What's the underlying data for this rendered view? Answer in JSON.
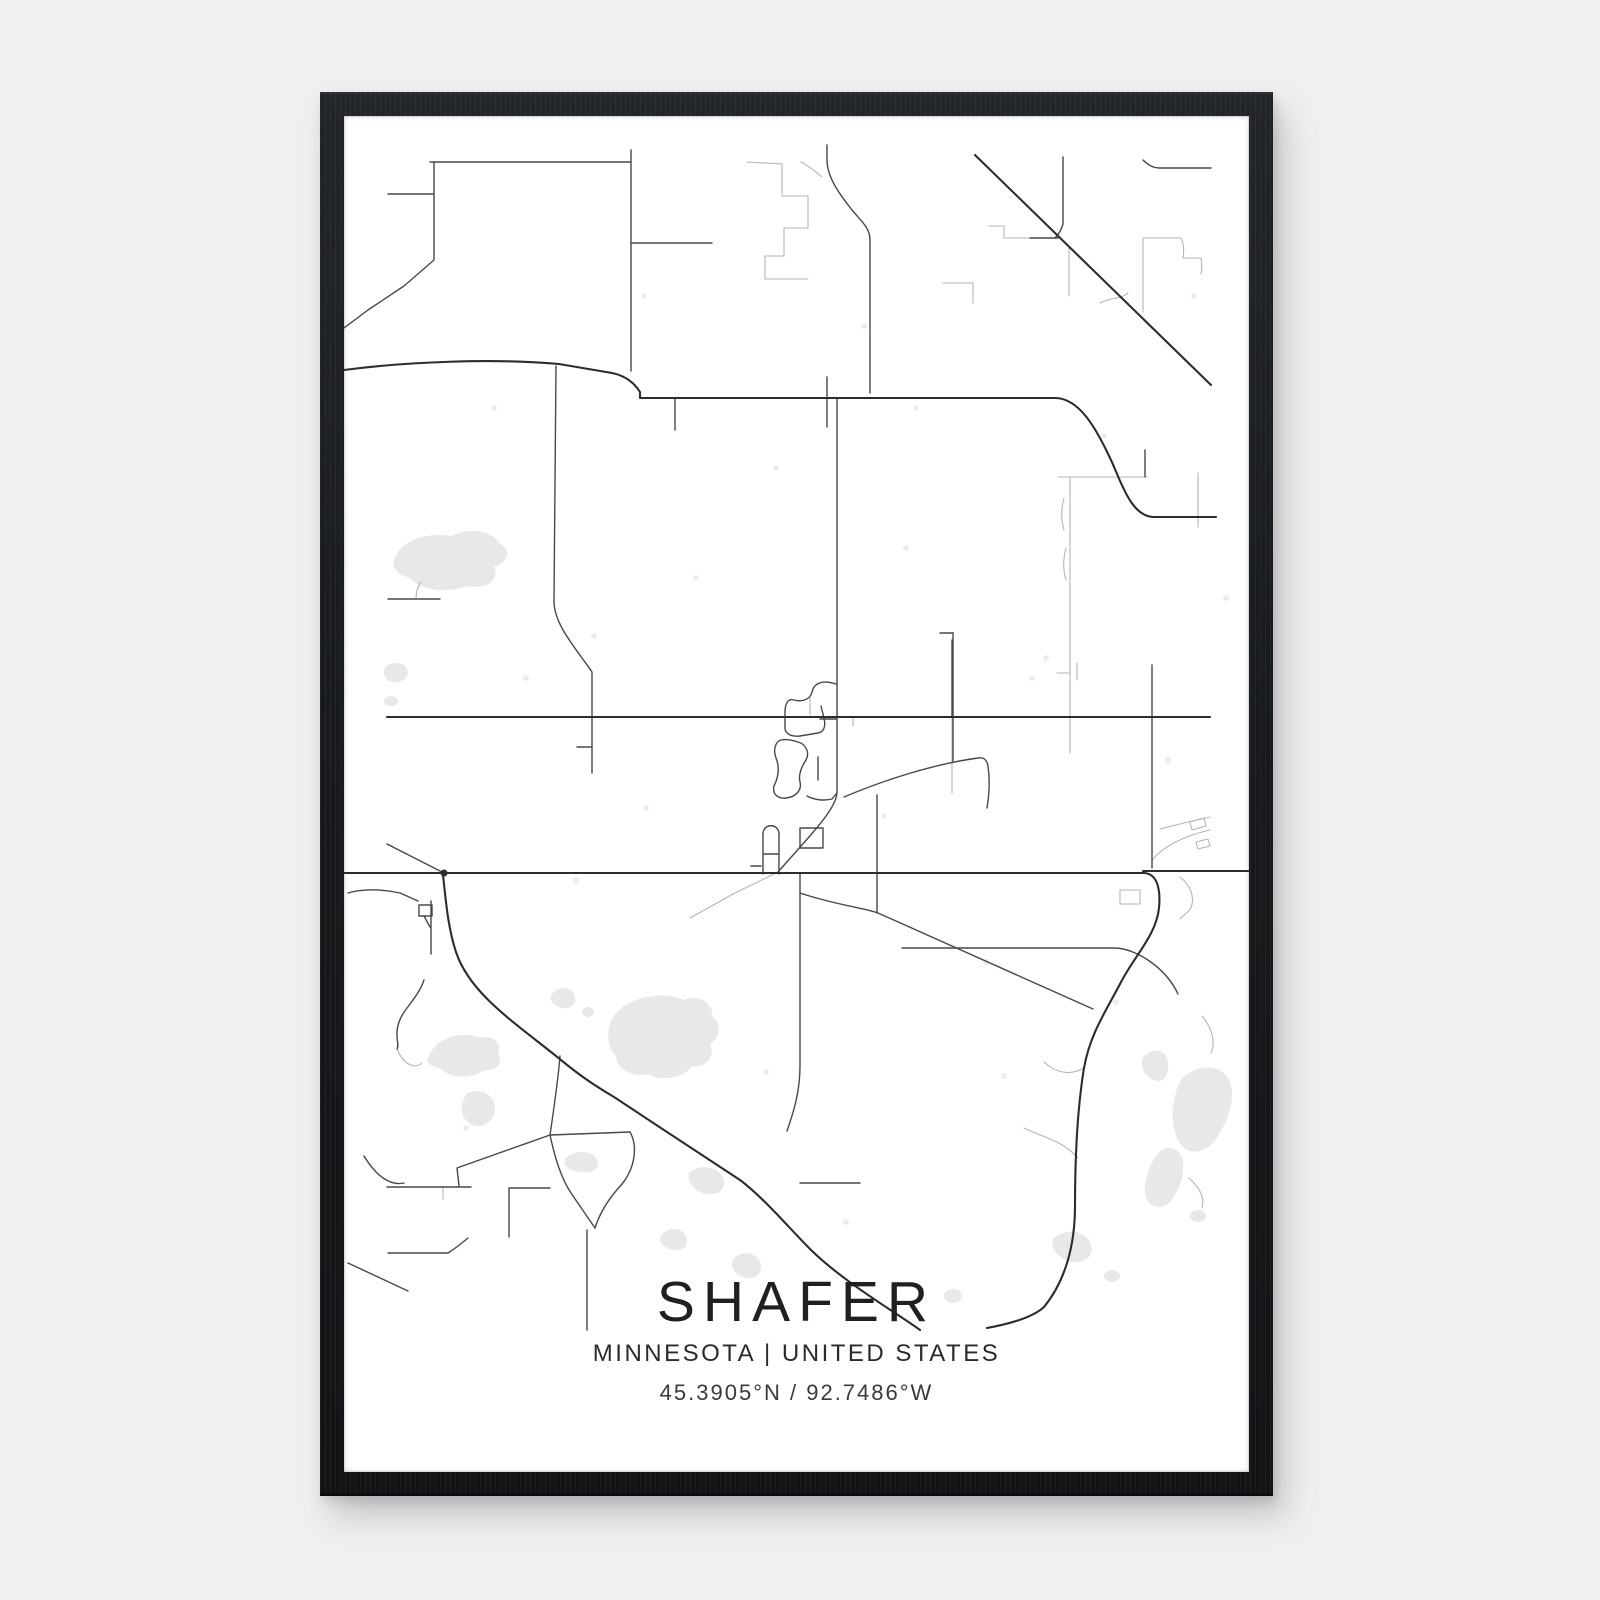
{
  "page": {
    "background": "#f0f0f1"
  },
  "poster": {
    "frame_color": "#191b1e",
    "paper_color": "#ffffff",
    "title": "SHAFER",
    "subtitle": "MINNESOTA | UNITED STATES",
    "coordinates": "45.3905°N / 92.7486°W",
    "map": {
      "location": "Shafer, Minnesota, United States",
      "viewBox": "0 0 905 1356",
      "road_color_main": "#2c2c2f",
      "road_color_medium": "#48484c",
      "road_color_light": "#b4b4b9",
      "water_color": "#e8e8ea",
      "speckle_color": "#ededef",
      "layers": [
        {
          "id": "water",
          "type": "fill",
          "color": "#e8e8ea",
          "paths": [
            "M52,440 C58,424 84,416 108,420 C128,410 150,416 156,428 C168,434 164,446 150,451 C156,463 144,474 124,470 C102,478 76,474 66,462 C52,458 46,450 52,440 Z",
            "M42,551 C48,545 60,546 63,553 C66,561 58,568 48,566 C40,564 38,556 42,551 Z",
            "M40,585 a7,5 0 1 0 14,0 a7,5 0 1 0 -14,0 Z",
            "M85,940 C92,922 118,914 136,922 C150,918 158,928 154,938 C160,946 152,956 140,954 C128,964 104,962 96,952 C86,950 80,946 85,940 Z",
            "M122,978 C132,972 146,976 150,986 C154,998 146,1010 134,1010 C122,1010 116,998 118,988 Z",
            "M270,900 C282,882 316,874 340,884 C356,878 370,888 368,900 C378,908 376,922 366,928 C372,940 362,952 348,950 C340,962 318,966 304,958 C288,962 272,952 272,940 C262,932 262,910 270,900 Z",
            "M208,878 C214,870 226,870 230,878 C234,886 228,894 218,892 C210,890 204,884 208,878 Z",
            "M238,896 a6,5 0 1 0 12,0 a6,5 0 1 0 -12,0 Z",
            "M222,1042 C230,1034 246,1034 252,1042 C258,1050 250,1058 238,1056 C228,1056 216,1050 222,1042 Z",
            "M800,940 C812,930 822,934 824,946 C826,960 818,968 810,964 C800,960 794,948 800,940 Z",
            "M840,960 C860,946 880,950 886,966 C892,984 884,1004 874,1020 C866,1034 850,1040 840,1032 C830,1022 826,1002 830,986 C832,974 834,968 840,960 Z",
            "M812,1040 C820,1028 834,1030 838,1042 C842,1056 836,1074 826,1086 C818,1094 806,1092 802,1082 C798,1070 804,1052 812,1040 Z",
            "M846,1100 a8,6 0 1 0 16,0 a8,6 0 1 0 -16,0 Z",
            "M346,1056 C356,1048 372,1050 378,1060 C384,1070 376,1080 364,1078 C352,1078 340,1064 346,1056 Z",
            "M390,1142 C398,1134 412,1136 416,1146 C420,1156 412,1164 402,1162 C392,1160 384,1150 390,1142 Z",
            "M318,1118 C326,1110 338,1112 342,1120 C346,1130 338,1136 330,1134 C320,1132 312,1126 318,1118 Z",
            "M710,1122 C722,1112 740,1114 746,1126 C752,1138 742,1148 728,1146 C716,1144 704,1132 710,1122 Z",
            "M760,1160 a8,6 0 1 0 16,0 a8,6 0 1 0 -16,0 Z",
            "M600,1180 a9,7 0 1 0 18,0 a9,7 0 1 0 -18,0 Z"
          ]
        },
        {
          "id": "speckles",
          "type": "fill",
          "color": "#ededef",
          "paths": [],
          "dots": [
            [
              150,
              292,
              3
            ],
            [
              352,
              462,
              3
            ],
            [
              562,
              432,
              3
            ],
            [
              688,
              562,
              3
            ],
            [
              232,
              764,
              3
            ],
            [
              642,
              846,
              3
            ],
            [
              422,
              956,
              3
            ],
            [
              702,
              542,
              3
            ],
            [
              824,
              644,
              3
            ],
            [
              122,
              1012,
              3
            ],
            [
              502,
              1106,
              3
            ],
            [
              772,
              886,
              3
            ],
            [
              302,
              692,
              3
            ],
            [
              572,
              292,
              3
            ],
            [
              882,
              482,
              3
            ],
            [
              182,
              562,
              3
            ],
            [
              432,
              352,
              3
            ],
            [
              250,
              520,
              3
            ],
            [
              660,
              960,
              3
            ],
            [
              540,
              700,
              3
            ],
            [
              300,
              180,
              3
            ],
            [
              520,
              210,
              3
            ],
            [
              760,
              320,
              3
            ],
            [
              850,
              180,
              3
            ]
          ]
        },
        {
          "id": "roads-light",
          "type": "stroke",
          "color": "#b4b4b9",
          "width": 1.1,
          "paths": [
            "M403,46 L438,48 V80 H464 V112 H440 V140 H421 V163 H446",
            "M446,163 H464",
            "M457,46 C465,50 472,56 478,61",
            "M799,122 V196",
            "M799,122 H837 C840,128 840,136 839,142 H857 C858,148 858,153 857,158",
            "M645,110 H660 V122 H686",
            "M725,131 V180",
            "M714,361 H803",
            "M726,362 V637",
            "M713,557 H726",
            "M720,382 C717,393 717,404 720,414",
            "M722,432 C719,443 719,454 722,464",
            "M854,357 V411",
            "M756,187 C768,181 778,183 784,177",
            "M733,547 V564",
            "M608,601 V677",
            "M434,756 L389,778 L346,802",
            "M836,761 C847,770 851,781 847,792 C843,798 838,800 836,803",
            "M776,774 H796 V788 H776 Z",
            "M816,713 L840,707 L866,701",
            "M846,706 l14,-4 l2,8 l-14,4 Z",
            "M852,726 l12,-3 l2,7 l-12,3 Z",
            "M866,714 C840,720 820,730 808,744",
            "M680,1012 C700,1022 718,1024 734,1042",
            "M700,946 C712,957 726,960 740,952",
            "M858,900 C868,912 872,926 867,937",
            "M845,1062 C856,1072 861,1082 858,1092",
            "M466,599 V581",
            "M599,167 H629 V187",
            "M72,483 C72,476 74,470 77,466",
            "M53,933 C60,950 72,953 78,947",
            "M99,1071 V1083",
            "M509,601 V610"
          ]
        },
        {
          "id": "roads-medium",
          "type": "stroke",
          "color": "#48484c",
          "width": 1.4,
          "paths": [
            "M86,46 H287",
            "M287,34 V255",
            "M287,127 H368",
            "M90,46 V144 L60,170 L24,194 L0,212",
            "M44,78 H90",
            "M44,483 H96",
            "M212,250 L210,485 C210,508 230,530 248,556 L248,657",
            "M233,631 H248",
            "M483,29 V44 C483,62 497,80 508,94 C518,106 526,112 526,124 V277",
            "M483,261 V311",
            "M331,282 V314",
            "M493,282 V676 C493,688 478,706 465,721 L434,756",
            "M533,679 V797",
            "M456,757 V950 C456,975 450,995 443,1015",
            "M456,777 C492,789 516,791 534,797 L749,893",
            "M608,524 V601",
            "M596,517 H609",
            "M609,517 V645",
            "M500,681 C540,664 590,648 634,642 C640,641 643,644 644,650 C646,664 645,680 643,692",
            "M808,549 V752",
            "M719,41 V108 C717,115 714,119 711,122",
            "M686,122 H714",
            "M799,44 C804,49 809,52 815,52 H867",
            "M801,334 V361",
            "M43,728 L100,757",
            "M4,777 C22,772 42,774 56,777 L74,785",
            "M87,785 V838",
            "M80,864 C74,882 60,892 55,906 C50,921 56,928 53,933",
            "M165,1072 V1121",
            "M165,1072 H206",
            "M43,1071 H127",
            "M44,1137 H104 C112,1132 118,1127 124,1122",
            "M216,940 C214,965 210,992 206,1019",
            "M206,1019 L113,1052 L115,1070",
            "M206,1019 C211,1042 217,1062 227,1077 L251,1112",
            "M206,1019 L286,1016",
            "M286,1016 C294,1030 291,1052 278,1068 C266,1081 256,1096 251,1112",
            "M243,1114 V1214",
            "M4,1147 L64,1175",
            "M20,1040 C32,1060 46,1070 60,1067",
            "M558,832 H770 C792,832 822,852 834,878",
            "M456,1067 H516",
            "M492,568 C480,564 470,566 468,576 C466,584 458,586 450,584 C444,582 441,588 441,596 V612 C441,618 448,621 456,620 L474,617 C480,616 482,610 480,602 L477,590",
            "M492,603 H476",
            "M437,624 C431,626 429,634 432,642 C436,652 434,662 430,670 C428,678 434,683 442,682 C452,681 458,674 456,666 C454,658 458,650 462,644 C466,637 462,628 454,626 C448,624 442,623 437,624 Z",
            "M474,641 V664",
            "M463,680 C470,684 480,685 488,683 L492,678",
            "M456,712 H479 V732 H456 Z",
            "M419,718 C419,707 435,707 435,718",
            "M419,718 V758",
            "M435,718 V758",
            "M419,738 H435",
            "M407,750 H417",
            "M75,789 H88 V800 H75 Z",
            "M80,800 L86,811"
          ]
        },
        {
          "id": "roads-main",
          "type": "stroke",
          "color": "#2c2c2f",
          "width": 2.1,
          "dots": [
            [
              100,
              757,
              3.5
            ]
          ],
          "paths": [
            "M0,254 C60,246 150,242 215,248 L268,257 C283,260 291,268 296,276 L296,282 H711 C735,282 752,312 766,342 C776,362 786,401 810,401 H872",
            "M43,601 H866",
            "M0,757 H799",
            "M799,757 C812,757 817,770 815,792 C812,820 790,840 776,868 C762,895 746,918 740,952 C733,995 731,1050 731,1090 C731,1128 722,1164 700,1191 C688,1202 665,1208 643,1212",
            "M799,755 H905",
            "M99,759 C102,786 104,812 112,836 C126,878 170,906 217,944 C240,963 255,972 270,981 C312,1009 360,1040 396,1064 C420,1082 445,1112 467,1134 C500,1166 545,1192 576,1214",
            "M631,39 L867,269"
          ]
        }
      ]
    }
  }
}
